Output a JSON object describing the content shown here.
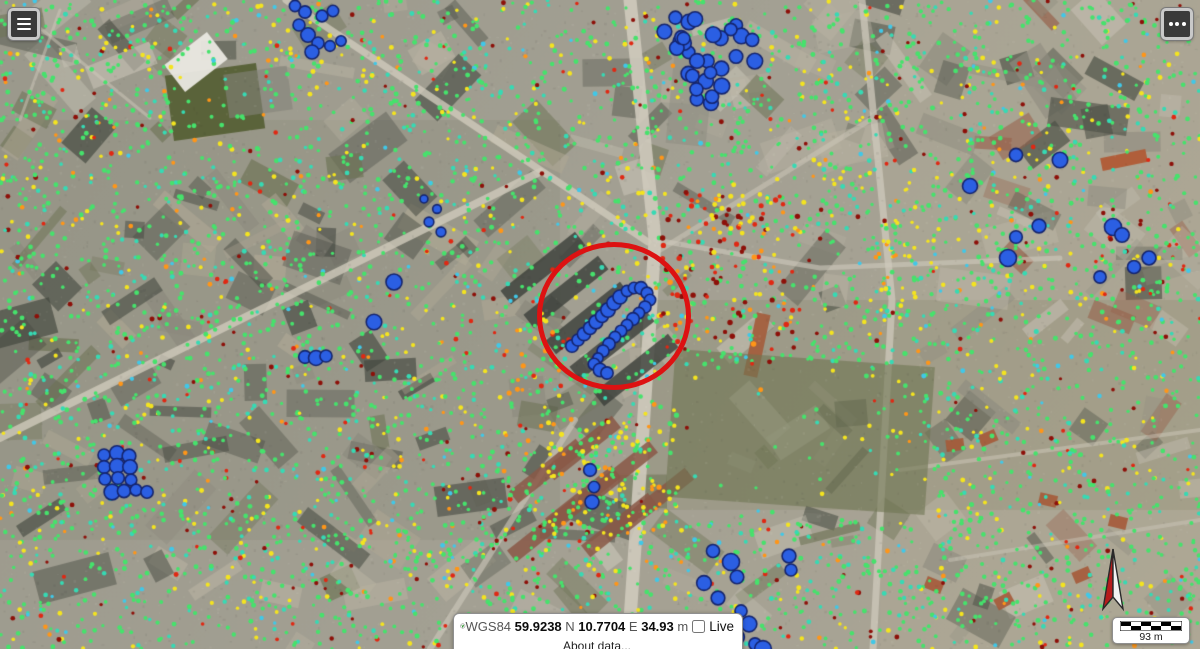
{
  "controls": {
    "menu_button_icon": "hamburger-icon",
    "more_button_icon": "ellipsis-icon"
  },
  "status_bar": {
    "datum_label": "WGS84",
    "lat_value": "59.9238",
    "lat_suffix": "N",
    "lon_value": "10.7704",
    "lon_suffix": "E",
    "elev_value": "34.93",
    "elev_suffix": "m",
    "live_label": "Live",
    "live_checked": false,
    "about_link": "About data..."
  },
  "scale_bar": {
    "label": "93 m"
  },
  "annotation_circle": {
    "cx": 614,
    "cy": 316,
    "rx": 72,
    "ry": 69,
    "stroke": "#dd1212",
    "stroke_width": 5
  },
  "map": {
    "seed": 1337,
    "palette": {
      "green": "#46e26c",
      "teal": "#36dab4",
      "cyan": "#40c8e8",
      "yellow": "#f4e41f",
      "orange": "#ff9618",
      "red": "#e02813",
      "darkred": "#8d1009",
      "blue": "#2b5fe3",
      "blue_outline": "#14246e"
    },
    "scatter": {
      "fields": [
        {
          "region": [
            0,
            0,
            1200,
            649
          ],
          "count": 5200,
          "r": [
            1.6,
            2.5
          ],
          "weights": {
            "green": 0.6,
            "teal": 0.15,
            "cyan": 0.03,
            "yellow": 0.12,
            "orange": 0.03,
            "red": 0.03,
            "darkred": 0.04
          }
        },
        {
          "region": [
            660,
            190,
            140,
            160
          ],
          "count": 95,
          "r": [
            1.8,
            2.8
          ],
          "weights": {
            "red": 0.42,
            "darkred": 0.38,
            "orange": 0.12,
            "yellow": 0.08
          }
        },
        {
          "region": [
            540,
            410,
            140,
            125
          ],
          "count": 130,
          "r": [
            1.7,
            2.6
          ],
          "weights": {
            "yellow": 0.52,
            "orange": 0.14,
            "green": 0.34
          }
        },
        {
          "region": [
            688,
            192,
            85,
            45
          ],
          "count": 30,
          "r": [
            1.8,
            2.6
          ],
          "weights": {
            "yellow": 0.65,
            "orange": 0.2,
            "red": 0.15
          }
        },
        {
          "region": [
            496,
            326,
            75,
            72
          ],
          "count": 22,
          "r": [
            1.8,
            2.6
          ],
          "weights": {
            "orange": 0.55,
            "red": 0.2,
            "yellow": 0.25
          }
        },
        {
          "region": [
            862,
            235,
            55,
            215
          ],
          "count": 45,
          "r": [
            1.6,
            2.4
          ],
          "weights": {
            "yellow": 0.55,
            "green": 0.35,
            "orange": 0.1
          }
        },
        {
          "region": [
            40,
            15,
            150,
            110
          ],
          "count": 40,
          "r": [
            1.6,
            2.4
          ],
          "weights": {
            "yellow": 0.45,
            "green": 0.55
          }
        },
        {
          "region": [
            1080,
            190,
            120,
            120
          ],
          "count": 28,
          "r": [
            1.6,
            2.4
          ],
          "weights": {
            "red": 0.28,
            "darkred": 0.24,
            "green": 0.48
          }
        }
      ],
      "sparse_zones": [
        [
          655,
          365,
          265,
          155,
          0.85
        ],
        [
          168,
          66,
          95,
          72,
          0.6
        ]
      ],
      "blue_blobs": [
        {
          "type": "ellipse",
          "cx": 706,
          "cy": 57,
          "rx": 50,
          "ry": 50,
          "count": 30,
          "r": [
            6,
            8
          ]
        },
        {
          "type": "points",
          "r": 6,
          "pts": [
            [
              295,
              6
            ],
            [
              305,
              12
            ],
            [
              299,
              25
            ],
            [
              308,
              35
            ],
            [
              318,
              43
            ],
            [
              330,
              46
            ],
            [
              341,
              41
            ],
            [
              322,
              16
            ],
            [
              333,
              11
            ],
            [
              312,
              52
            ]
          ]
        },
        {
          "type": "points",
          "r": 6,
          "pts": [
            [
              572,
              346
            ],
            [
              578,
              340
            ],
            [
              584,
              334
            ],
            [
              590,
              328
            ],
            [
              596,
              322
            ],
            [
              602,
              316
            ],
            [
              608,
              310
            ],
            [
              614,
              303
            ],
            [
              620,
              297
            ],
            [
              627,
              291
            ],
            [
              634,
              288
            ],
            [
              641,
              288
            ],
            [
              647,
              293
            ],
            [
              650,
              300
            ],
            [
              645,
              307
            ],
            [
              639,
              313
            ],
            [
              633,
              319
            ],
            [
              627,
              325
            ],
            [
              621,
              331
            ],
            [
              615,
              337
            ],
            [
              609,
              344
            ],
            [
              603,
              351
            ],
            [
              598,
              358
            ],
            [
              594,
              364
            ],
            [
              600,
              370
            ],
            [
              607,
              373
            ]
          ]
        },
        {
          "type": "points",
          "r": 6.5,
          "pts": [
            [
              104,
              455
            ],
            [
              117,
              453
            ],
            [
              129,
              456
            ],
            [
              104,
              467
            ],
            [
              117,
              466
            ],
            [
              130,
              467
            ],
            [
              105,
              479
            ],
            [
              118,
              478
            ],
            [
              131,
              480
            ],
            [
              112,
              492
            ],
            [
              124,
              491
            ],
            [
              136,
              490
            ],
            [
              147,
              492
            ]
          ]
        },
        {
          "type": "points",
          "r": 7,
          "pts": [
            [
              713,
              551
            ],
            [
              731,
              562
            ],
            [
              737,
              577
            ],
            [
              704,
              583
            ],
            [
              718,
              598
            ],
            [
              741,
              611
            ],
            [
              749,
              624
            ],
            [
              737,
              637
            ],
            [
              755,
              644
            ],
            [
              763,
              649
            ],
            [
              789,
              556
            ],
            [
              791,
              570
            ]
          ]
        },
        {
          "type": "points",
          "r": 7,
          "pts": [
            [
              1016,
              155
            ],
            [
              1060,
              160
            ],
            [
              970,
              186
            ],
            [
              1039,
              226
            ],
            [
              1016,
              237
            ],
            [
              1008,
              258
            ],
            [
              1113,
              227
            ],
            [
              1122,
              235
            ],
            [
              1149,
              258
            ],
            [
              1134,
              267
            ],
            [
              1100,
              277
            ]
          ]
        },
        {
          "type": "points",
          "r": 6.5,
          "pts": [
            [
              394,
              282
            ],
            [
              374,
              322
            ],
            [
              305,
              357
            ],
            [
              316,
              358
            ],
            [
              326,
              356
            ],
            [
              590,
              470
            ],
            [
              594,
              487
            ],
            [
              592,
              502
            ]
          ]
        },
        {
          "type": "points",
          "r": 4.5,
          "pts": [
            [
              424,
              199
            ],
            [
              437,
              209
            ],
            [
              429,
              222
            ],
            [
              441,
              232
            ]
          ]
        }
      ]
    }
  }
}
